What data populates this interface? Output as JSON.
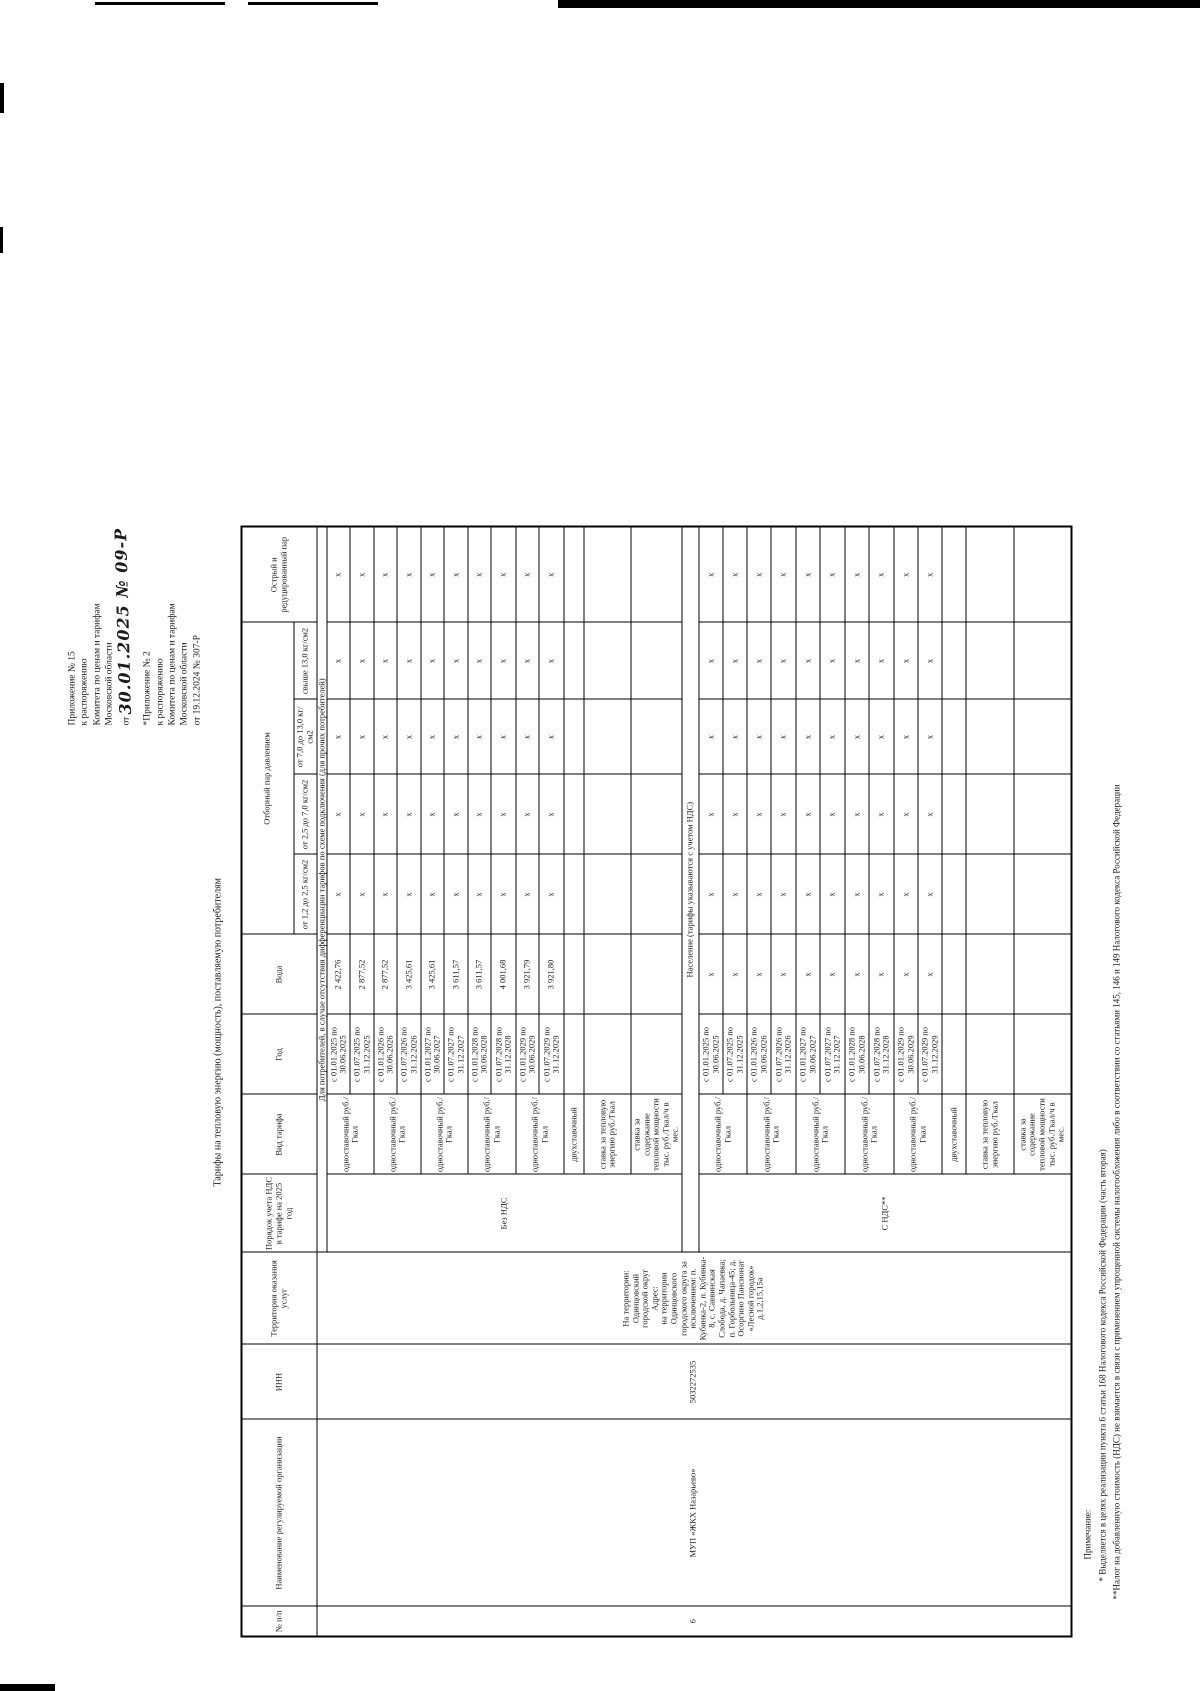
{
  "colors": {
    "ink": "#1b1b1b",
    "paper": "#ffffff"
  },
  "annotations": {
    "block1_lines": [
      "Приложение № 15",
      "к распоряжению",
      "Комитета по ценам и тарифам",
      "Московской области"
    ],
    "block1_date_prefix": "от",
    "block1_handwritten": "30.01.2025 № 09-Р",
    "block2_lines": [
      "*Приложение № 2",
      "к распоряжению",
      "Комитета по ценам и тарифам",
      "Московской области",
      "от 19.12.2024 № 307-Р"
    ]
  },
  "title": "Тарифы на тепловую энергию (мощность), поставляемую потребителям",
  "table": {
    "headers": {
      "num": "№ п/п",
      "org": "Наименование регулируемой организации",
      "inn": "ИНН",
      "territory": "Территория оказания услуг",
      "vat": "Порядок учета НДС в тарифе на 2025 год",
      "tariff_type": "Вид тарифа",
      "year": "Год",
      "water": "Вода",
      "steam_group": "Отборный пар давлением",
      "steam_col_1": "от 1,2 до 2,5 кг/см2",
      "steam_col_2": "от 2,5 до 7,0 кг/см2",
      "steam_col_3": "от 7,0 до 13,0 кг/см2",
      "steam_col_4": "свыше 13,0 кг/см2",
      "sharp_steam": "Острый и редуцированный пар"
    },
    "row": {
      "num": "6",
      "org": "МУП «ЖКХ Назарьево»",
      "inn": "5032272535",
      "territory_lines": [
        "На территории:",
        "Одинцовский",
        "городской округ",
        "Адрес:",
        "на территории",
        "Одинцовского",
        "городского округа за",
        "исключением: п.",
        "Кубинка-2, п. Кубинка-",
        "8, с. Саввинская",
        "Слобода, д. Чапаевка;",
        "п. Горбольница-45; д.",
        "Осоргино Пансионат",
        "«Лесной городок»",
        "д.1,2,15,15а"
      ]
    },
    "labels": {
      "one_part": "одноставочный руб./Гкал",
      "two_part": "двухставочный",
      "rate_energy": "ставка за тепловую энергию руб./Гкал",
      "rate_capacity": "ставка за содержание тепловой мощности тыс. руб./Гкал/ч в мес."
    },
    "mark": "x",
    "periods": [
      {
        "date": "с 01.01.2025 по 30.06.2025"
      },
      {
        "date": "с 01.07.2025 по 31.12.2025"
      },
      {
        "date": "с 01.01.2026 по 30.06.2026"
      },
      {
        "date": "с 01.07.2026 по 31.12.2026"
      },
      {
        "date": "с 01.01.2027 по 30.06.2027"
      },
      {
        "date": "с 01.07.2027 по 31.12.2027"
      },
      {
        "date": "с 01.01.2028 по 30.06.2028"
      },
      {
        "date": "с 01.07.2028 по 31.12.2028"
      },
      {
        "date": "с 01.01.2029 по 30.06.2029"
      },
      {
        "date": "с 01.07.2029 по 31.12.2029"
      }
    ],
    "section1": {
      "header": "Для потребителей, в случае отсутствия дифференциации тарифов по схеме подключения  (для прочих потребителей)",
      "vat": "Без НДС",
      "water_values": [
        "2 422,76",
        "2 877,52",
        "2 877,52",
        "3 425,61",
        "3 425,61",
        "3 611,57",
        "3 611,57",
        "4 001,68",
        "3 921,79",
        "3 921,80"
      ]
    },
    "section2": {
      "header": "Население (тарифы указываются с учетом НДС)",
      "vat": "С НДС**"
    }
  },
  "footnotes": [
    "Примечание:",
    "* Выделяется в целях реализации пункта 6 статьи 168 Налогового кодекса Российской Федерации (часть вторая)",
    "**Налог на добавленную стоимость (НДС) не взимается в связи с применением упрощенной системы налогообложения либо в соответствии со статьями 145, 146 и 149 Налогового кодекса Российской Федерации"
  ]
}
